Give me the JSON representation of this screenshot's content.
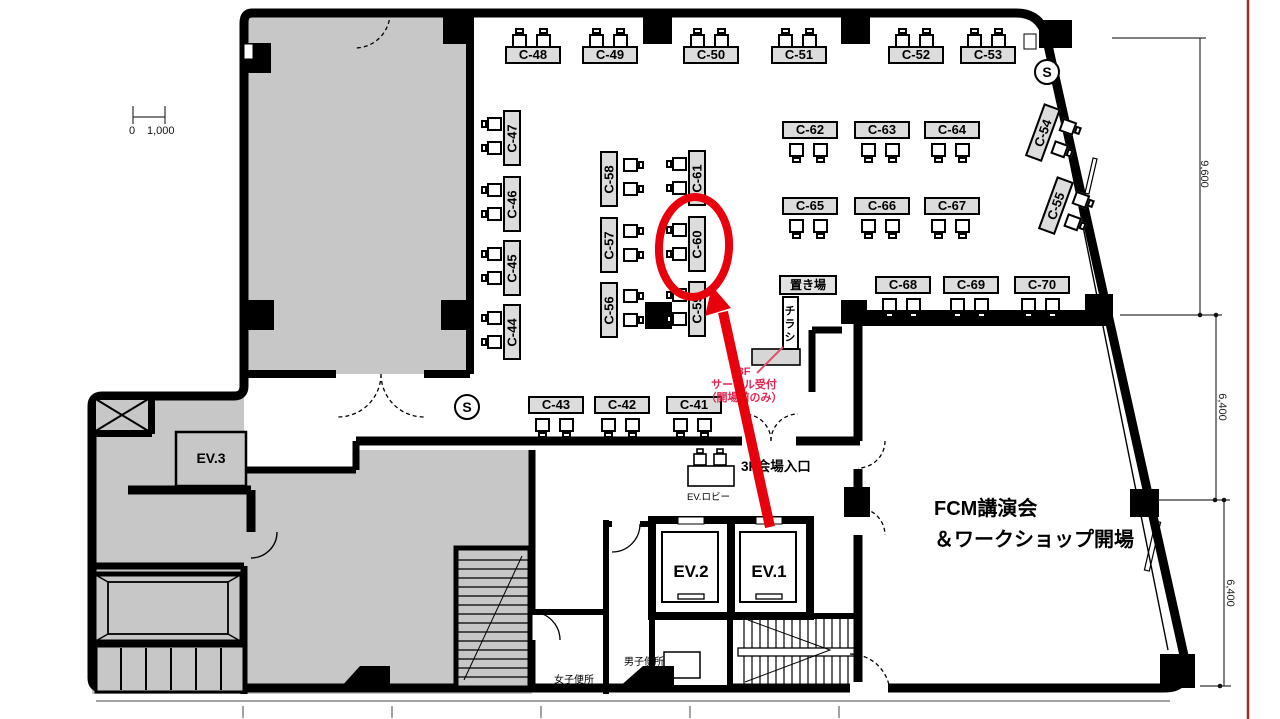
{
  "booths": [
    "C-41",
    "C-42",
    "C-43",
    "C-44",
    "C-45",
    "C-46",
    "C-47",
    "C-48",
    "C-49",
    "C-50",
    "C-51",
    "C-52",
    "C-53",
    "C-54",
    "C-55",
    "C-56",
    "C-57",
    "C-58",
    "C-59",
    "C-60",
    "C-61",
    "C-62",
    "C-63",
    "C-64",
    "C-65",
    "C-66",
    "C-67",
    "C-68",
    "C-69",
    "C-70"
  ],
  "rooms": {
    "ev1": "EV.1",
    "ev2": "EV.2",
    "ev3": "EV.3",
    "ev_lobby": "EV.ロビー",
    "womens_toilet": "女子便所",
    "mens_toilet": "男子便所",
    "fcm_line1": "FCM講演会",
    "fcm_line2": "＆ワークショップ開場",
    "entrance": "3F会場入口",
    "storage": "置き場",
    "flyers": "チラシ",
    "stair_mark": "S"
  },
  "annotations": {
    "reception_line1": "3F",
    "reception_line2": "サークル受付",
    "reception_line3": "（開場前のみ）",
    "highlighted_booth": "C-60"
  },
  "dimensions": {
    "scale_zero": "0",
    "scale_value": "1,000",
    "right_top": "9,600",
    "right_mid": "6,400",
    "right_bottom": "6,400"
  },
  "colors": {
    "highlight": "#e8000d",
    "note_text": "#e32552",
    "wall": "#000000",
    "room_fill": "#c7c7c7",
    "booth_fill": "#dcdcdc",
    "dim_red_line": "#a62828"
  }
}
